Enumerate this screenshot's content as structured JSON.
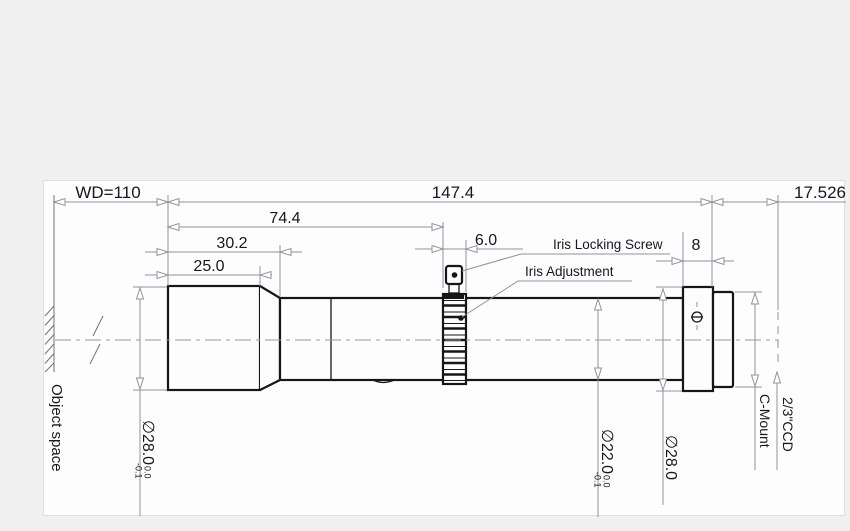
{
  "drawing": {
    "title": "lens-mechanical-drawing",
    "dimensions": {
      "working_distance": "WD=110",
      "total_length": "147.4",
      "flange_focal_distance": "17.526",
      "length_74": "74.4",
      "length_30": "30.2",
      "length_25": "25.0",
      "iris_ring_width": "6.0",
      "flange_width": "8"
    },
    "labels": {
      "iris_locking_screw": "Iris Locking Screw",
      "iris_adjustment": "Iris Adjustment",
      "object_space": "Object space",
      "c_mount": "C-Mount",
      "ccd": "2/3\"CCD"
    },
    "diameters": {
      "front": {
        "value": "∅28.0",
        "tol_upper": "0.0",
        "tol_lower": "-0.1"
      },
      "barrel": {
        "value": "∅22.0",
        "tol_upper": "0.0",
        "tol_lower": "-0.1"
      },
      "rear": {
        "value": "∅28.0"
      }
    },
    "colors": {
      "outline": "#161616",
      "dimension_lines": "#8d929b",
      "centerline": "#999999",
      "background": "#f0f0f1",
      "canvas": "#fdfdfe"
    }
  }
}
